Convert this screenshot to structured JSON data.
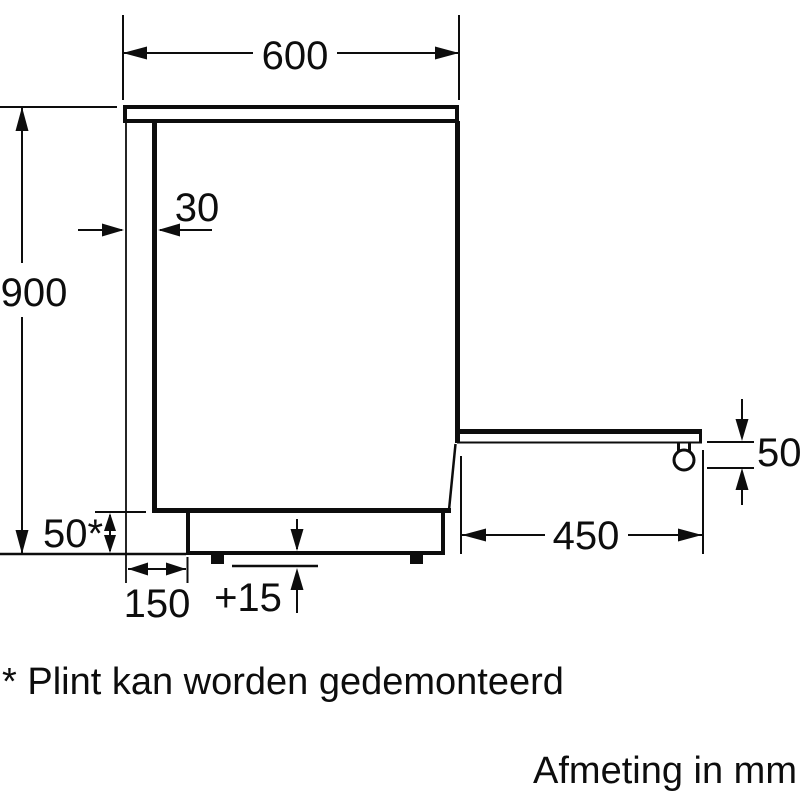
{
  "diagram": {
    "title": "appliance-side-view-dimension-drawing",
    "units_note": "Afmeting in mm",
    "footnote": "* Plint kan worden gedemonteerd",
    "dimensions": {
      "top_width": "600",
      "left_height": "900",
      "worktop_overhang": "30",
      "plinth_height": "50*",
      "plinth_recess": "150",
      "height_adjust": "+15",
      "open_door_depth": "450",
      "door_clearance": "50"
    },
    "colors": {
      "line": "#0d0d0d",
      "background": "#ffffff"
    }
  }
}
